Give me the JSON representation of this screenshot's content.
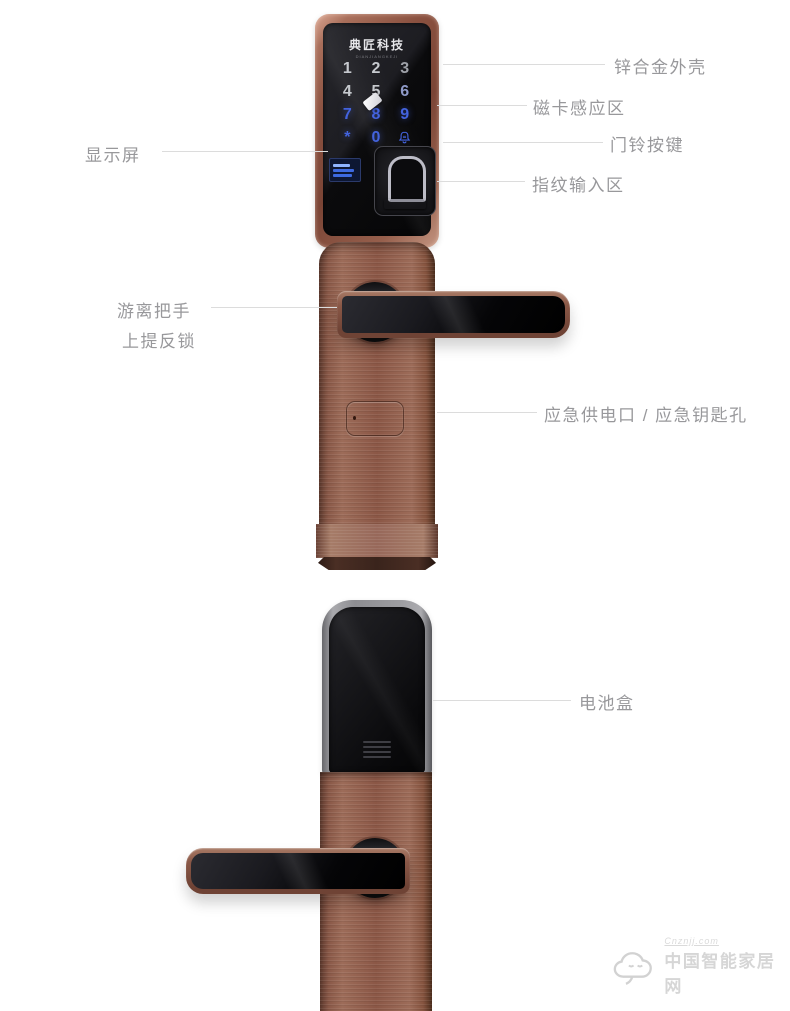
{
  "lock_front": {
    "brand": "典匠科技",
    "brand_sub": "DIANJIANGKEJI",
    "keypad": {
      "keys": [
        {
          "label": "1",
          "tone": "gray"
        },
        {
          "label": "2",
          "tone": "gray"
        },
        {
          "label": "3",
          "tone": "gray-dim"
        },
        {
          "label": "4",
          "tone": "gray"
        },
        {
          "label": "5",
          "tone": "gray"
        },
        {
          "label": "6",
          "tone": "blue-dim"
        },
        {
          "label": "7",
          "tone": "blue"
        },
        {
          "label": "8",
          "tone": "blue"
        },
        {
          "label": "9",
          "tone": "blue"
        },
        {
          "label": "*",
          "tone": "blue"
        },
        {
          "label": "0",
          "tone": "blue"
        },
        {
          "label": "",
          "tone": "blue",
          "icon": "doorbell-icon"
        }
      ]
    }
  },
  "callouts": {
    "zinc_shell": "锌合金外壳",
    "card_zone": "磁卡感应区",
    "doorbell": "门铃按键",
    "fingerprint": "指纹输入区",
    "display": "显示屏",
    "handle_line1": "游离把手",
    "handle_line2": "上提反锁",
    "emergency": "应急供电口 / 应急钥匙孔",
    "battery": "电池盒"
  },
  "watermark": {
    "url": "Cnznjj.com",
    "site": "中国智能家居网"
  },
  "colors": {
    "bronze": "#8b5746",
    "key_blue": "#4363de",
    "key_gray": "#c6c9ce",
    "label_gray": "#98989b",
    "line_gray": "#dcdcdc"
  }
}
